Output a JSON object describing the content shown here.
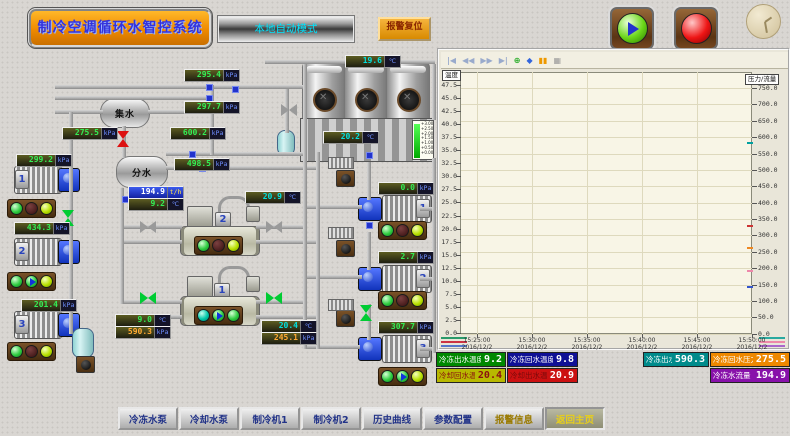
{
  "header": {
    "title": "制冷空调循环水智控系统",
    "mode": "本地自动模式",
    "alarm_reset": "报警复位"
  },
  "diagram": {
    "collector_tank": "集水",
    "distributor_tank": "分水",
    "tower": {
      "level_marks": [
        "+3.00",
        "+2.50",
        "+2.00",
        "+1.50",
        "+1.00",
        "+0.50",
        "+0.00"
      ]
    },
    "chiller1_label": "1",
    "chiller2_label": "2",
    "pump_left_labels": [
      "1",
      "2",
      "3"
    ],
    "pump_right_labels": [
      "1",
      "2",
      "3"
    ],
    "indicators": {
      "pump_left": [
        [
          "on",
          "off",
          "rdy"
        ],
        [
          "on",
          "run",
          "rdy"
        ],
        [
          "on",
          "off",
          "rdy"
        ]
      ],
      "pump_right": [
        [
          "on",
          "off",
          "rdy"
        ],
        [
          "on",
          "off",
          "rdy"
        ],
        [
          "on",
          "run",
          "rdy"
        ]
      ],
      "chiller2": [
        "on",
        "off",
        "rdy"
      ],
      "chiller1": [
        "teal",
        "run",
        "on"
      ]
    },
    "gauges": [
      {
        "id": "supply-header-pressure-1",
        "value": "295.4",
        "unit": "kPa"
      },
      {
        "id": "supply-header-pressure-2",
        "value": "297.7",
        "unit": "kPa"
      },
      {
        "id": "collector-pressure",
        "value": "275.5",
        "unit": "kPa"
      },
      {
        "id": "distributor-pressure-1",
        "value": "600.2",
        "unit": "kPa"
      },
      {
        "id": "distributor-pressure-2",
        "value": "498.5",
        "unit": "kPa"
      },
      {
        "id": "chw-pump1-pressure",
        "value": "299.2",
        "unit": "kPa"
      },
      {
        "id": "chw-pump2-pressure",
        "value": "434.3",
        "unit": "kPa"
      },
      {
        "id": "chw-pump3-pressure",
        "value": "201.4",
        "unit": "kPa"
      },
      {
        "id": "chw-flow",
        "value": "194.9",
        "unit": "t/h"
      },
      {
        "id": "chw-supply-temp",
        "value": "9.2",
        "unit": "℃"
      },
      {
        "id": "cooling-water-temp",
        "value": "20.9",
        "unit": "℃"
      },
      {
        "id": "chiller1-chw-temp",
        "value": "9.0",
        "unit": "℃"
      },
      {
        "id": "chiller1-chw-pressure",
        "value": "590.3",
        "unit": "kPa"
      },
      {
        "id": "chiller1-cw-temp",
        "value": "20.4",
        "unit": "℃"
      },
      {
        "id": "chiller1-cw-pressure",
        "value": "245.1",
        "unit": "kPa"
      },
      {
        "id": "cw-pump1-pressure",
        "value": "0.0",
        "unit": "kPa"
      },
      {
        "id": "cw-pump2-pressure",
        "value": "2.7",
        "unit": "kPa"
      },
      {
        "id": "cw-pump3-pressure",
        "value": "307.7",
        "unit": "kPa"
      },
      {
        "id": "tower-inlet-temp",
        "value": "19.6",
        "unit": "℃"
      },
      {
        "id": "tower-basin-temp",
        "value": "20.2",
        "unit": "℃"
      }
    ]
  },
  "chart": {
    "left_axis_label": "温度",
    "right_axis_label": "压力/流量",
    "left_ticks": [
      "47.5",
      "45.0",
      "42.5",
      "40.0",
      "37.5",
      "35.0",
      "32.5",
      "30.0",
      "27.5",
      "25.0",
      "22.5",
      "20.0",
      "17.5",
      "15.0",
      "12.5",
      "10.0",
      "7.5",
      "5.0",
      "2.5",
      "0.0"
    ],
    "right_ticks": [
      "750.0",
      "700.0",
      "650.0",
      "600.0",
      "550.0",
      "500.0",
      "450.0",
      "400.0",
      "350.0",
      "300.0",
      "250.0",
      "200.0",
      "150.0",
      "100.0",
      "50.0",
      "0.0"
    ],
    "x_ticks": [
      {
        "time": "15:25:00",
        "date": "2016/12/2"
      },
      {
        "time": "15:30:00",
        "date": "2016/12/2"
      },
      {
        "time": "15:35:00",
        "date": "2016/12/2"
      },
      {
        "time": "15:40:00",
        "date": "2016/12/2"
      },
      {
        "time": "15:45:00",
        "date": "2016/12/2"
      },
      {
        "time": "15:50:00",
        "date": "2016/12/2"
      }
    ],
    "toolbar": [
      {
        "name": "first",
        "glyph": "|◀",
        "color": "#99aacc"
      },
      {
        "name": "rewind",
        "glyph": "◀◀",
        "color": "#99aacc"
      },
      {
        "name": "forward",
        "glyph": "▶▶",
        "color": "#99aacc"
      },
      {
        "name": "last",
        "glyph": "▶|",
        "color": "#99aacc"
      },
      {
        "name": "zoom",
        "glyph": "⊕",
        "color": "#22aa22"
      },
      {
        "name": "pan",
        "glyph": "◆",
        "color": "#3366dd"
      },
      {
        "name": "pause",
        "glyph": "▮▮",
        "color": "#ee9900"
      },
      {
        "name": "grid",
        "glyph": "▦",
        "color": "#9a9a9a"
      }
    ]
  },
  "chart_data": {
    "type": "line",
    "title": "实时趋势",
    "x_range": [
      "15:25:00",
      "15:50:00"
    ],
    "x_date": "2016/12/2",
    "left_axis": {
      "label": "温度",
      "ylim": [
        0,
        50
      ],
      "tick_step": 2.5
    },
    "right_axis": {
      "label": "压力/流量",
      "ylim": [
        0,
        800
      ],
      "tick_step": 50
    },
    "grid": true,
    "series": [
      {
        "name": "冷冻出水温度",
        "axis": "left",
        "current": 9.2,
        "color": "#008800",
        "values": []
      },
      {
        "name": "冷冻回水温度",
        "axis": "left",
        "current": 9.8,
        "color": "#101088",
        "values": []
      },
      {
        "name": "冷却回水温",
        "axis": "left",
        "current": 20.4,
        "color": "#b8b800",
        "values": []
      },
      {
        "name": "冷却出水温",
        "axis": "left",
        "current": 20.9,
        "color": "#cc1111",
        "values": []
      },
      {
        "name": "冷冻出水压力",
        "axis": "right",
        "current": 590.3,
        "color": "#008b8b",
        "values": []
      },
      {
        "name": "冷冻回水压力",
        "axis": "right",
        "current": 275.5,
        "color": "#ee8800",
        "values": []
      },
      {
        "name": "冷冻水流量",
        "axis": "right",
        "current": 194.9,
        "color": "#8811aa",
        "values": []
      }
    ]
  },
  "status": [
    {
      "label": "冷冻出水温度",
      "value": "9.2",
      "bg": "#008800"
    },
    {
      "label": "冷冻回水温度",
      "value": "9.8",
      "bg": "#101095"
    },
    {
      "label": "冷冻出水压力",
      "value": "590.3",
      "bg": "#008b8b"
    },
    {
      "label": "冷冻回水压力",
      "value": "275.5",
      "bg": "#ee8800"
    },
    {
      "label": "冷却回水温",
      "value": "20.4",
      "bg": "#b8b800"
    },
    {
      "label": "冷却出水温",
      "value": "20.9",
      "bg": "#cc1111"
    },
    {
      "label": "冷冻水流量",
      "value": "194.9",
      "bg": "#8811aa"
    }
  ],
  "nav": [
    "冷冻水泵",
    "冷却水泵",
    "制冷机1",
    "制冷机2",
    "历史曲线",
    "参数配置",
    "报警信息",
    "返回主页"
  ]
}
